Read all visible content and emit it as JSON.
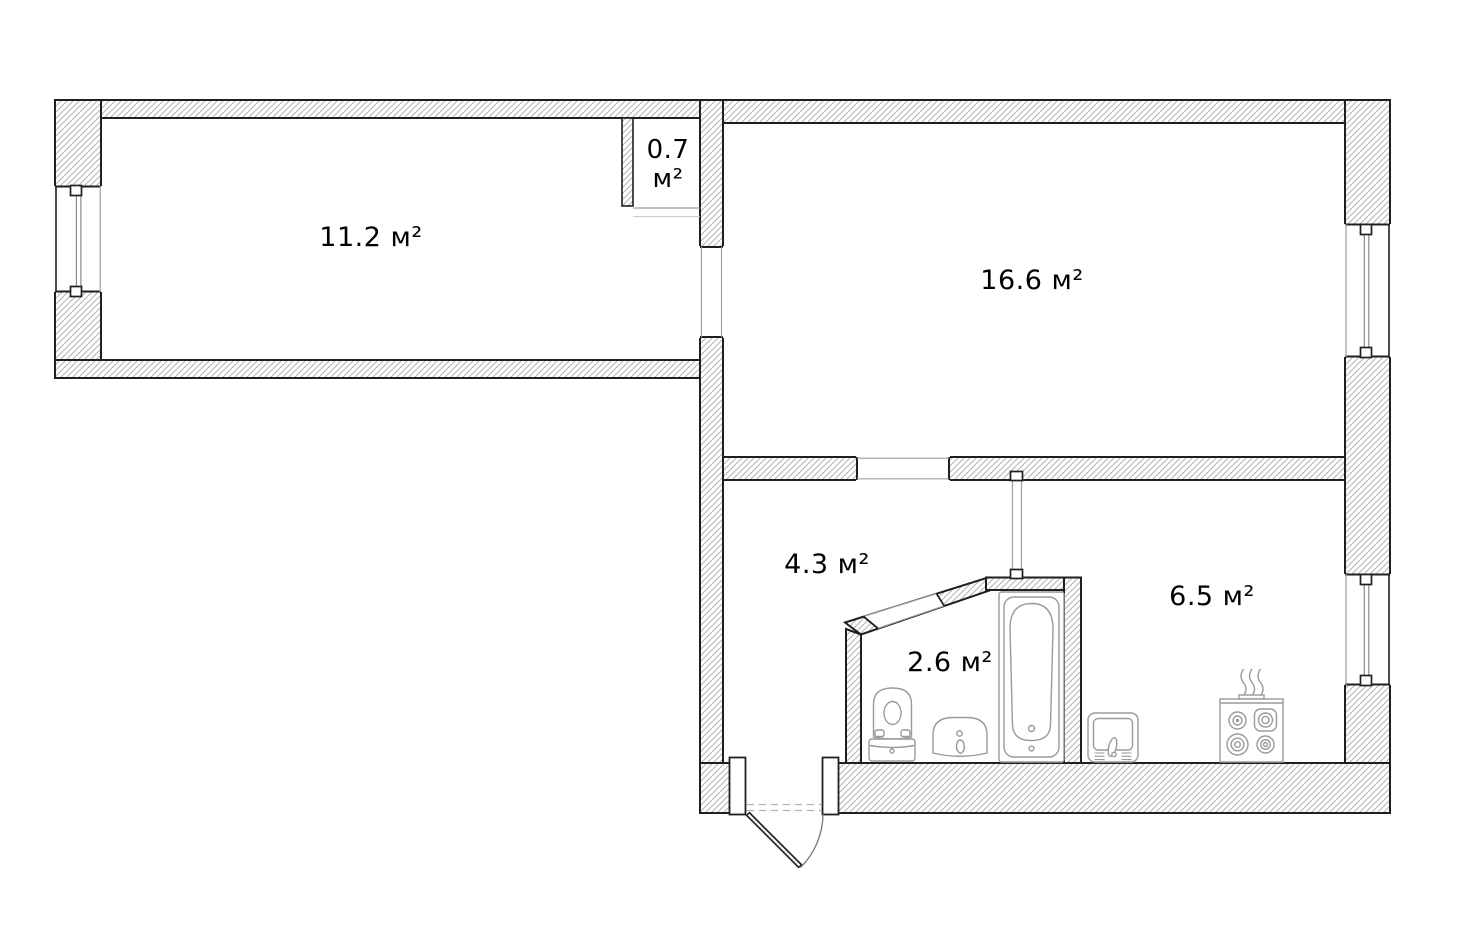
{
  "document": {
    "type": "apartment floor plan",
    "background": "#ffffff"
  },
  "rooms": {
    "room_small": {
      "name": "room 11.2",
      "area_label": "11.2 м²"
    },
    "room_large": {
      "name": "room 16.6",
      "area_label": "16.6 м²"
    },
    "hallway": {
      "name": "hallway 4.3",
      "area_label": "4.3 м²"
    },
    "bathroom": {
      "name": "bathroom 2.6",
      "area_label": "2.6 м²"
    },
    "kitchen": {
      "name": "kitchen 6.5",
      "area_label": "6.5 м²"
    },
    "niche": {
      "name": "niche 0.7",
      "area_value": "0.7",
      "area_unit": "м²"
    }
  },
  "fixtures": {
    "bathroom": [
      "toilet",
      "washbasin",
      "bathtub"
    ],
    "kitchen": [
      "kitchen-sink",
      "gas-stove"
    ]
  },
  "openings": {
    "windows": [
      "room-small-left-wall",
      "room-large-right-wall",
      "kitchen-right-wall"
    ],
    "entrance_door": "hallway-bottom-swing-door",
    "interior_doorways": [
      "room-small-to-room-large",
      "room-large-to-hallway",
      "hallway-to-bathroom"
    ]
  },
  "colors": {
    "wall_outline": "#1f1f1f",
    "hatch_line": "#b5b5b5",
    "fixture_stroke": "#9a9a9a",
    "thin_line": "#9e9e9e",
    "dash_line": "#b0b0b0",
    "text": "#000000",
    "background": "#ffffff"
  }
}
